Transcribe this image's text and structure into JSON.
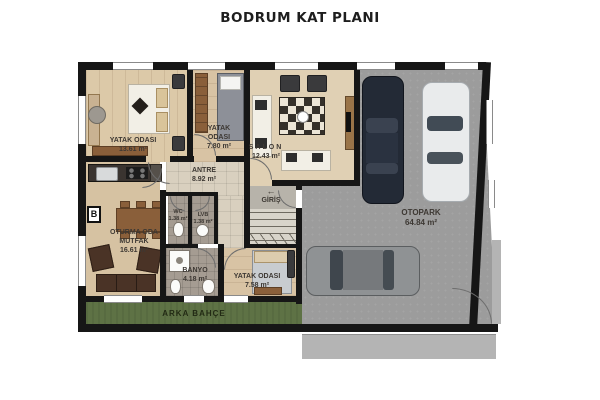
{
  "title": "BODRUM KAT PLANI",
  "rooms": {
    "bedroom1": {
      "name": "YATAK ODASI",
      "area": "13.61 m²"
    },
    "bedroom2": {
      "name": "YATAK ODASI",
      "area": "7.80 m²"
    },
    "salon": {
      "name": "SALON",
      "area": "12.43 m²"
    },
    "antre": {
      "name": "ANTRE",
      "area": "8.92 m²"
    },
    "giris": {
      "name": "GİRİŞ",
      "arrow": "←"
    },
    "wc": {
      "name": "WC",
      "area": "1.38 m²"
    },
    "lvb": {
      "name": "LVB",
      "area": "1.38 m²"
    },
    "living_kitchen": {
      "name": "OTURMA ODA",
      "name2": "MUTFAK",
      "area": "16.61 m²"
    },
    "banyo": {
      "name": "BANYO",
      "area": "4.18 m²"
    },
    "bedroom3": {
      "name": "YATAK ODASI",
      "area": "7.58 m²"
    },
    "otopark": {
      "name": "OTOPARK",
      "area": "64.84 m²"
    },
    "garden": {
      "name": "ARKA BAHÇE"
    }
  },
  "markers": {
    "column_label": "B"
  },
  "colors": {
    "wall": "#161616",
    "wood_floor": "#dcc9a8",
    "tile_floor": "#d9d0bf",
    "wet_floor": "#a59c92",
    "garage_floor": "#9c9c9c",
    "garden": "#5e7245",
    "car_navy": "#232a36",
    "car_white": "#e9ebec",
    "car_gray": "#8f9294"
  }
}
